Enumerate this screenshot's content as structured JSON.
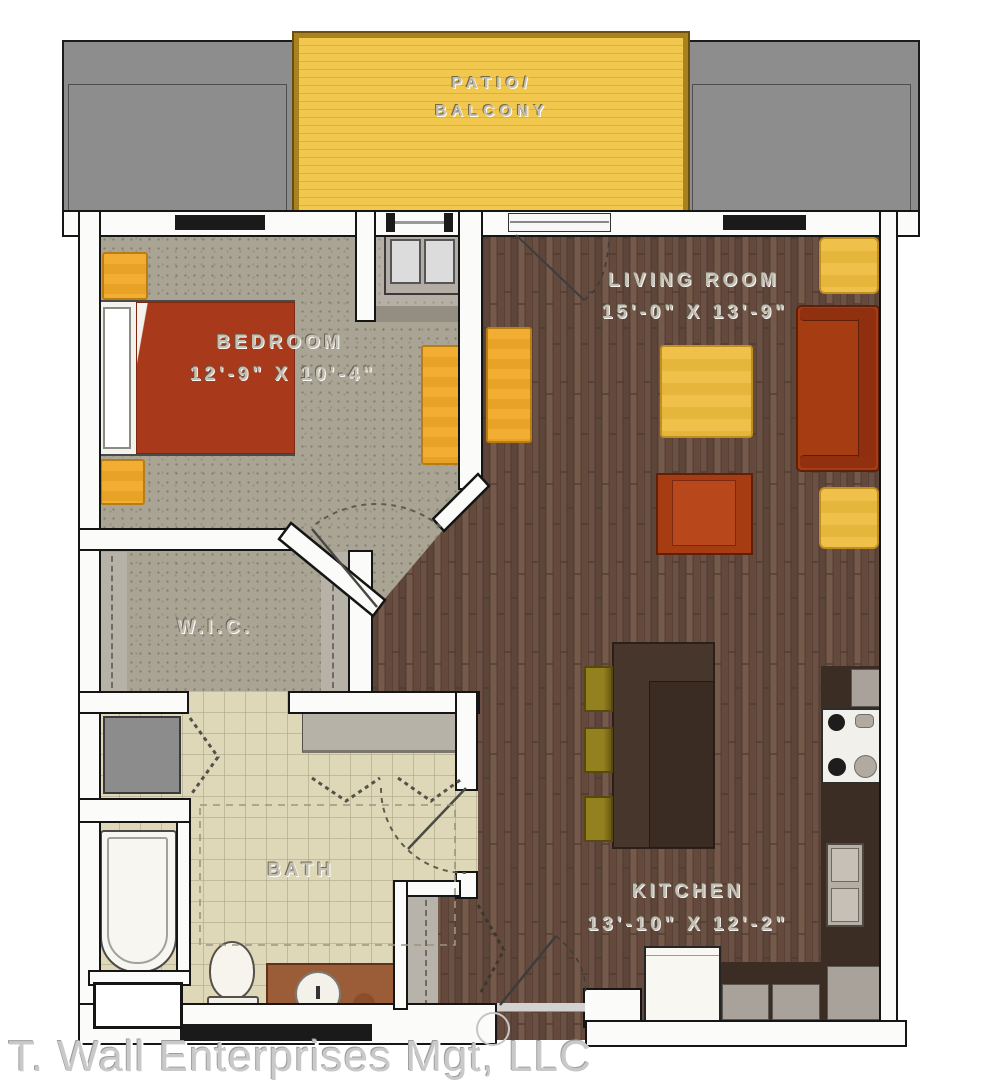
{
  "floor_plan": {
    "patio": {
      "line1": "PATIO/",
      "line2": "BALCONY"
    },
    "rooms": {
      "bedroom": {
        "name": "BEDROOM",
        "dimensions": "12'-9\" X 10'-4\""
      },
      "living_room": {
        "name": "LIVING ROOM",
        "dimensions": "15'-0\" X 13'-9\""
      },
      "wic": {
        "name": "W.I.C."
      },
      "bath": {
        "name": "BATH"
      },
      "kitchen": {
        "name": "KITCHEN",
        "dimensions": "13'-10\" X 12'-2\""
      }
    },
    "watermark": "T. Wall Enterprises Mgt, LLC",
    "colors": {
      "patio_deck": "#f1c74d",
      "neighbor_gray": "#8d8d8d",
      "carpet": "#a9a494",
      "wood_floor": "#6b5143",
      "tile": "#ded8b8",
      "accent_furniture_yellow": "#f2ae33",
      "accent_furniture_red": "#a63c12",
      "wall": "#fbfbf9"
    }
  }
}
